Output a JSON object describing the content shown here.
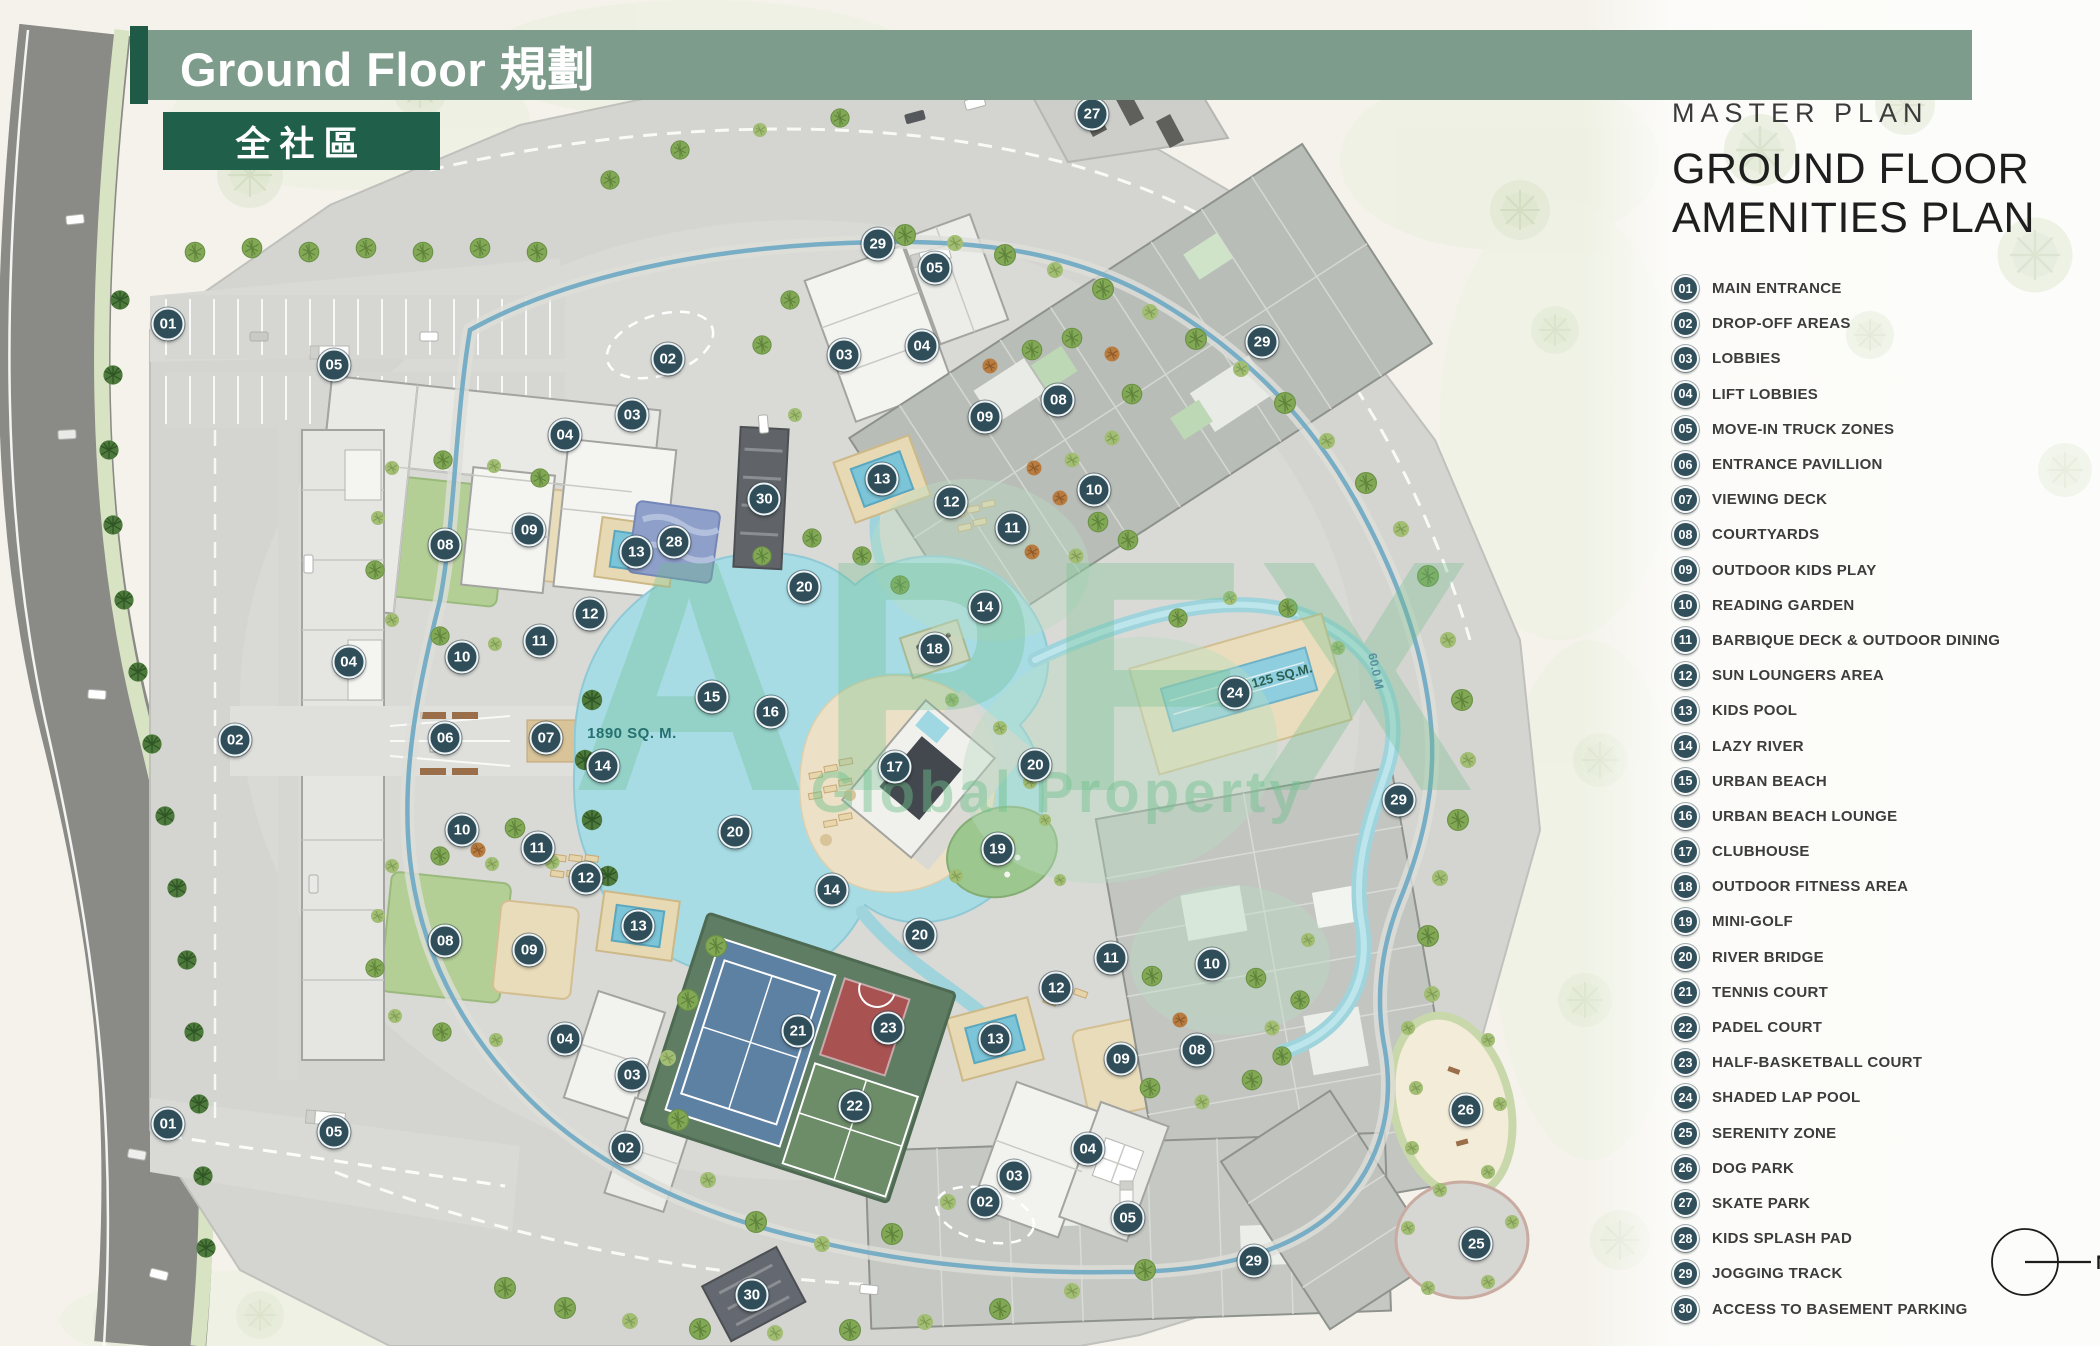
{
  "header": {
    "title": "Ground Floor 規劃",
    "badge": "全社區"
  },
  "panel": {
    "kicker": "MASTER PLAN",
    "title_line1": "GROUND FLOOR",
    "title_line2": "AMENITIES PLAN",
    "legend": [
      {
        "num": "01",
        "label": "MAIN ENTRANCE"
      },
      {
        "num": "02",
        "label": "DROP-OFF AREAS"
      },
      {
        "num": "03",
        "label": "LOBBIES"
      },
      {
        "num": "04",
        "label": "LIFT LOBBIES"
      },
      {
        "num": "05",
        "label": "MOVE-IN TRUCK ZONES"
      },
      {
        "num": "06",
        "label": "ENTRANCE PAVILLION"
      },
      {
        "num": "07",
        "label": "VIEWING DECK"
      },
      {
        "num": "08",
        "label": "COURTYARDS"
      },
      {
        "num": "09",
        "label": "OUTDOOR KIDS PLAY"
      },
      {
        "num": "10",
        "label": "READING GARDEN"
      },
      {
        "num": "11",
        "label": "BARBIQUE DECK & OUTDOOR DINING"
      },
      {
        "num": "12",
        "label": "SUN LOUNGERS AREA"
      },
      {
        "num": "13",
        "label": "KIDS POOL"
      },
      {
        "num": "14",
        "label": "LAZY RIVER"
      },
      {
        "num": "15",
        "label": "URBAN BEACH"
      },
      {
        "num": "16",
        "label": "URBAN BEACH LOUNGE"
      },
      {
        "num": "17",
        "label": "CLUBHOUSE"
      },
      {
        "num": "18",
        "label": "OUTDOOR FITNESS AREA"
      },
      {
        "num": "19",
        "label": "MINI-GOLF"
      },
      {
        "num": "20",
        "label": "RIVER BRIDGE"
      },
      {
        "num": "21",
        "label": "TENNIS COURT"
      },
      {
        "num": "22",
        "label": "PADEL COURT"
      },
      {
        "num": "23",
        "label": "HALF-BASKETBALL COURT"
      },
      {
        "num": "24",
        "label": "SHADED LAP POOL"
      },
      {
        "num": "25",
        "label": "SERENITY ZONE"
      },
      {
        "num": "26",
        "label": "DOG PARK"
      },
      {
        "num": "27",
        "label": "SKATE PARK"
      },
      {
        "num": "28",
        "label": "KIDS SPLASH PAD"
      },
      {
        "num": "29",
        "label": "JOGGING TRACK"
      },
      {
        "num": "30",
        "label": "ACCESS TO BASEMENT PARKING"
      }
    ]
  },
  "compass": {
    "label": "N"
  },
  "watermark": {
    "line1": "APFX",
    "line2": "Global Property"
  },
  "map": {
    "lagoon_area_label": "1890 SQ. M.",
    "lap_pool_area_label": "125 SQ.M.",
    "track_label": "60.0 M",
    "markers": [
      {
        "n": "27",
        "x": 52.0,
        "y": 8.5
      },
      {
        "n": "29",
        "x": 41.8,
        "y": 18.1
      },
      {
        "n": "05",
        "x": 44.5,
        "y": 19.9
      },
      {
        "n": "01",
        "x": 8.0,
        "y": 24.1
      },
      {
        "n": "05",
        "x": 15.9,
        "y": 27.1
      },
      {
        "n": "02",
        "x": 31.8,
        "y": 26.7
      },
      {
        "n": "03",
        "x": 40.2,
        "y": 26.4
      },
      {
        "n": "04",
        "x": 43.9,
        "y": 25.7
      },
      {
        "n": "29",
        "x": 60.1,
        "y": 25.4
      },
      {
        "n": "08",
        "x": 50.4,
        "y": 29.7
      },
      {
        "n": "09",
        "x": 46.9,
        "y": 31.0
      },
      {
        "n": "03",
        "x": 30.1,
        "y": 30.8
      },
      {
        "n": "04",
        "x": 26.9,
        "y": 32.3
      },
      {
        "n": "13",
        "x": 42.0,
        "y": 35.6
      },
      {
        "n": "12",
        "x": 45.3,
        "y": 37.3
      },
      {
        "n": "10",
        "x": 52.1,
        "y": 36.4
      },
      {
        "n": "11",
        "x": 48.2,
        "y": 39.2
      },
      {
        "n": "30",
        "x": 36.4,
        "y": 37.1
      },
      {
        "n": "09",
        "x": 25.2,
        "y": 39.4
      },
      {
        "n": "08",
        "x": 21.2,
        "y": 40.5
      },
      {
        "n": "13",
        "x": 30.3,
        "y": 41.0
      },
      {
        "n": "28",
        "x": 32.1,
        "y": 40.3
      },
      {
        "n": "20",
        "x": 38.3,
        "y": 43.6
      },
      {
        "n": "12",
        "x": 28.1,
        "y": 45.6
      },
      {
        "n": "14",
        "x": 46.9,
        "y": 45.1
      },
      {
        "n": "10",
        "x": 22.0,
        "y": 48.8
      },
      {
        "n": "11",
        "x": 25.7,
        "y": 47.6
      },
      {
        "n": "18",
        "x": 44.5,
        "y": 48.2
      },
      {
        "n": "04",
        "x": 16.6,
        "y": 49.2
      },
      {
        "n": "24",
        "x": 58.8,
        "y": 51.5
      },
      {
        "n": "15",
        "x": 33.9,
        "y": 51.8
      },
      {
        "n": "16",
        "x": 36.7,
        "y": 52.9
      },
      {
        "n": "02",
        "x": 11.2,
        "y": 55.0
      },
      {
        "n": "06",
        "x": 21.2,
        "y": 54.8
      },
      {
        "n": "07",
        "x": 26.0,
        "y": 54.8
      },
      {
        "n": "14",
        "x": 28.7,
        "y": 56.9
      },
      {
        "n": "17",
        "x": 42.6,
        "y": 57.0
      },
      {
        "n": "20",
        "x": 49.3,
        "y": 56.8
      },
      {
        "n": "29",
        "x": 66.6,
        "y": 59.4
      },
      {
        "n": "10",
        "x": 22.0,
        "y": 61.7
      },
      {
        "n": "11",
        "x": 25.6,
        "y": 63.0
      },
      {
        "n": "20",
        "x": 35.0,
        "y": 61.8
      },
      {
        "n": "19",
        "x": 47.5,
        "y": 63.1
      },
      {
        "n": "12",
        "x": 27.9,
        "y": 65.2
      },
      {
        "n": "14",
        "x": 39.6,
        "y": 66.1
      },
      {
        "n": "13",
        "x": 30.4,
        "y": 68.8
      },
      {
        "n": "20",
        "x": 43.8,
        "y": 69.5
      },
      {
        "n": "08",
        "x": 21.2,
        "y": 69.9
      },
      {
        "n": "09",
        "x": 25.2,
        "y": 70.6
      },
      {
        "n": "11",
        "x": 52.9,
        "y": 71.2
      },
      {
        "n": "10",
        "x": 57.7,
        "y": 71.6
      },
      {
        "n": "12",
        "x": 50.3,
        "y": 73.4
      },
      {
        "n": "21",
        "x": 38.0,
        "y": 76.6
      },
      {
        "n": "23",
        "x": 42.3,
        "y": 76.4
      },
      {
        "n": "13",
        "x": 47.4,
        "y": 77.2
      },
      {
        "n": "04",
        "x": 26.9,
        "y": 77.2
      },
      {
        "n": "08",
        "x": 57.0,
        "y": 78.0
      },
      {
        "n": "09",
        "x": 53.4,
        "y": 78.7
      },
      {
        "n": "03",
        "x": 30.1,
        "y": 79.9
      },
      {
        "n": "22",
        "x": 40.7,
        "y": 82.2
      },
      {
        "n": "26",
        "x": 69.8,
        "y": 82.5
      },
      {
        "n": "01",
        "x": 8.0,
        "y": 83.5
      },
      {
        "n": "05",
        "x": 15.9,
        "y": 84.1
      },
      {
        "n": "02",
        "x": 29.8,
        "y": 85.3
      },
      {
        "n": "04",
        "x": 51.8,
        "y": 85.4
      },
      {
        "n": "03",
        "x": 48.3,
        "y": 87.4
      },
      {
        "n": "02",
        "x": 46.9,
        "y": 89.3
      },
      {
        "n": "05",
        "x": 53.7,
        "y": 90.5
      },
      {
        "n": "25",
        "x": 70.3,
        "y": 92.4
      },
      {
        "n": "29",
        "x": 59.7,
        "y": 93.7
      },
      {
        "n": "30",
        "x": 35.8,
        "y": 96.2
      }
    ]
  }
}
